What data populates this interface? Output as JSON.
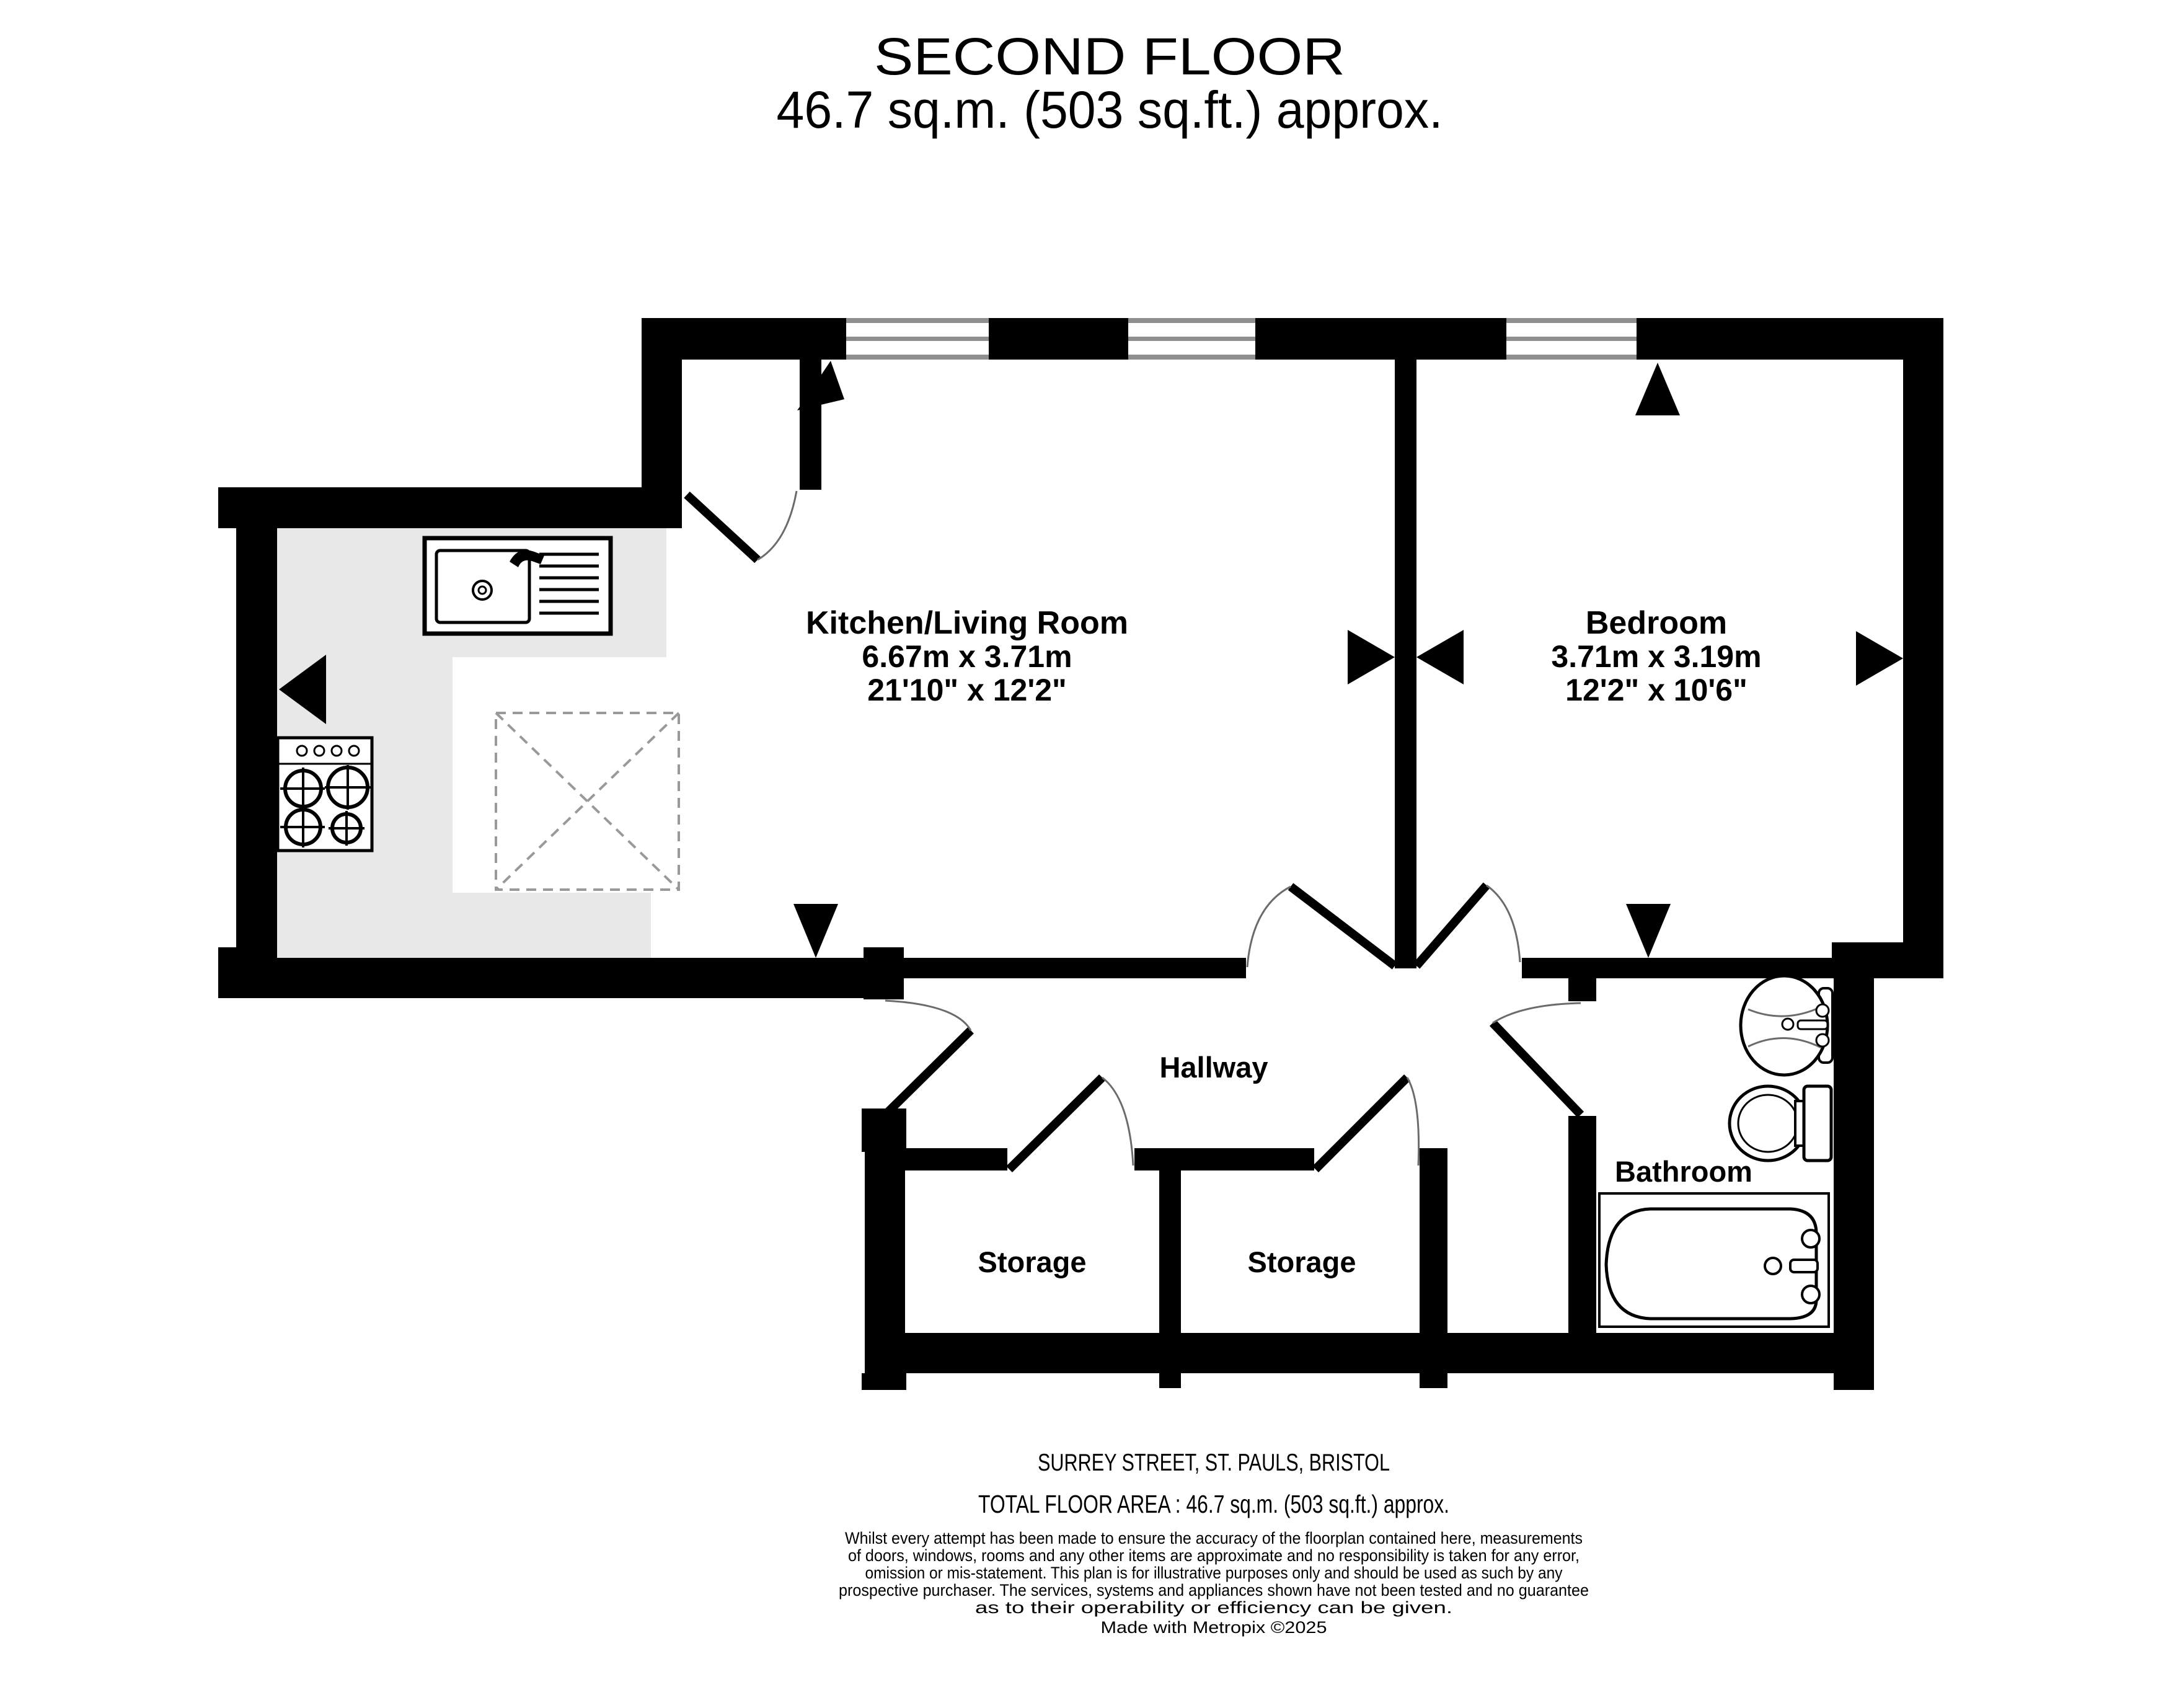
{
  "title": {
    "line1": "SECOND FLOOR",
    "line2": "46.7 sq.m. (503 sq.ft.) approx."
  },
  "rooms": {
    "kitchen": {
      "name": "Kitchen/Living Room",
      "dim_m": "6.67m  x 3.71m",
      "dim_ft": "21'10\"  x 12'2\""
    },
    "bedroom": {
      "name": "Bedroom",
      "dim_m": "3.71m  x 3.19m",
      "dim_ft": "12'2\"  x 10'6\""
    },
    "hallway": {
      "name": "Hallway"
    },
    "storage1": {
      "name": "Storage"
    },
    "storage2": {
      "name": "Storage"
    },
    "bathroom": {
      "name": "Bathroom"
    }
  },
  "footer": {
    "address": "SURREY STREET, ST. PAULS, BRISTOL",
    "total_area": "TOTAL FLOOR AREA : 46.7 sq.m. (503 sq.ft.) approx.",
    "disclaimer_lines": [
      "Whilst every attempt has been made to ensure the accuracy of the floorplan contained here, measurements",
      "of doors, windows, rooms and any other items are approximate and no responsibility is taken for any error,",
      "omission or mis-statement. This plan is for illustrative purposes only and should be used as such by any",
      "prospective purchaser. The services, systems and appliances shown have not been tested and no guarantee",
      "as to their operability or efficiency can be given."
    ],
    "credit": "Made with Metropix ©2025"
  },
  "colors": {
    "wall": "#000000",
    "counter": "#e8e8e8",
    "window_line": "#8f8f8f",
    "door_arc": "#6b6b6b",
    "dashed_feature": "#999999"
  }
}
